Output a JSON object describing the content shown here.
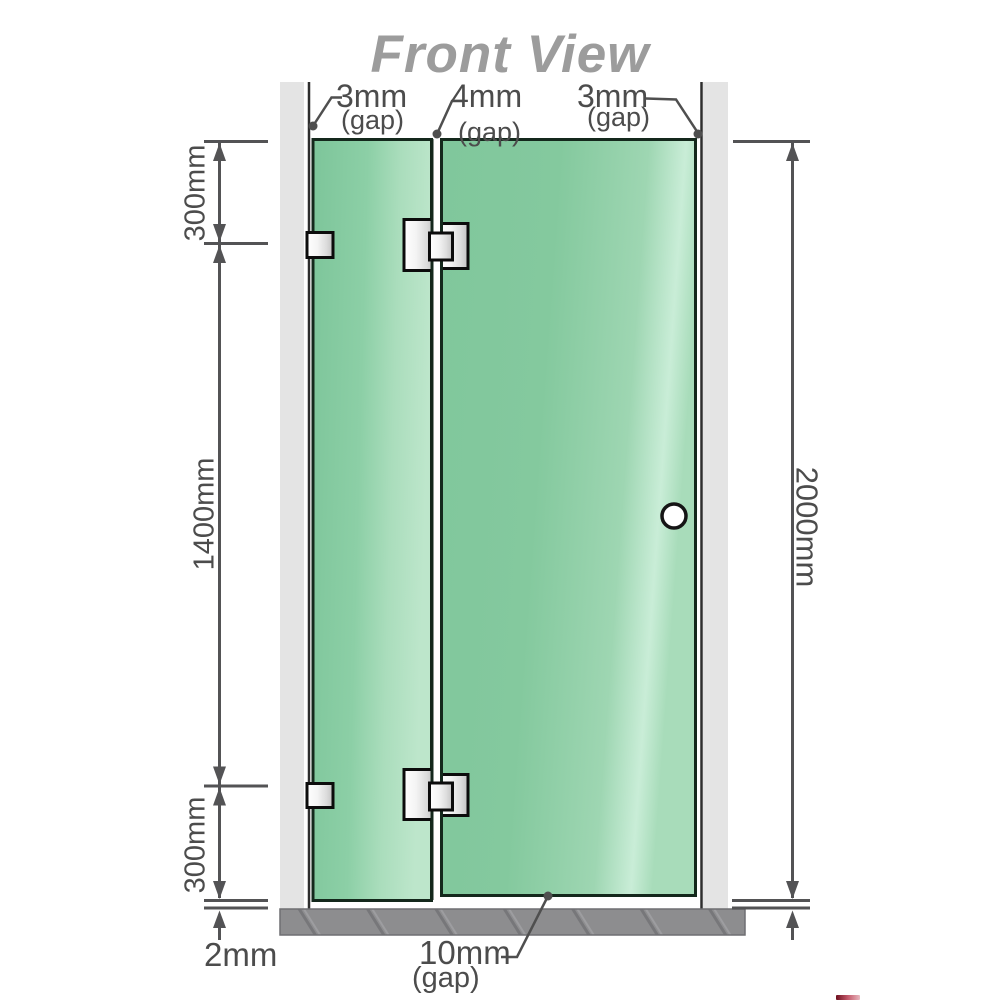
{
  "title": "Front View",
  "colors": {
    "glass_green": "#86c9a0",
    "glass_highlight": "#c9edd7",
    "glass_border": "#14281c",
    "wall_gray": "#e4e4e4",
    "wall_edge": "#2e2e2e",
    "floor_gray": "#8d8d8f",
    "metal_light": "#ffffff",
    "metal_dark": "#c2c2c2",
    "dimension_gray": "#535355",
    "label_gray": "#4c4c4c",
    "title_gray": "#9c9c9c"
  },
  "annotations": {
    "top_gaps": [
      {
        "value": "3mm",
        "unit": "(gap)"
      },
      {
        "value": "4mm",
        "unit": "(gap)"
      },
      {
        "value": "3mm",
        "unit": "(gap)"
      }
    ],
    "left_dimensions": {
      "top": "300mm",
      "middle": "1400mm",
      "bottom": "300mm"
    },
    "right_dimension": "2000mm",
    "bottom_dimensions": {
      "floor_gap": "2mm",
      "door_gap_value": "10mm",
      "door_gap_unit": "(gap)"
    }
  },
  "components": {
    "left_wall": "wall",
    "right_wall": "wall",
    "fixed_panel": "glass panel",
    "door_panel": "glass door panel",
    "hinges": 2,
    "wall_brackets": 2,
    "door_knob": "round knob",
    "floor": "hatched floor strip"
  }
}
